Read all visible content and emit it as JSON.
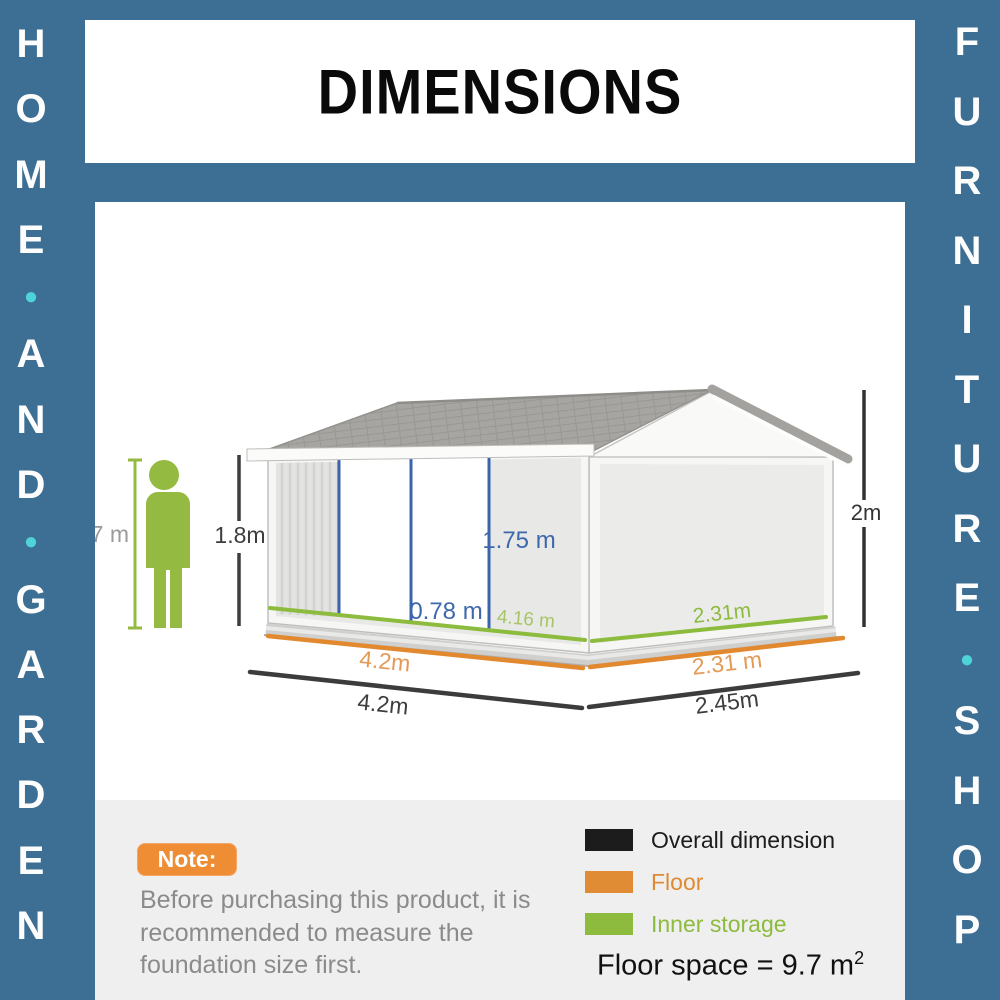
{
  "brand": {
    "left_letters": [
      "H",
      "O",
      "M",
      "E",
      "●",
      "A",
      "N",
      "D",
      "●",
      "G",
      "A",
      "R",
      "D",
      "E",
      "N"
    ],
    "right_letters": [
      "F",
      "U",
      "R",
      "N",
      "I",
      "T",
      "U",
      "R",
      "E",
      "●",
      "S",
      "H",
      "O",
      "P"
    ]
  },
  "header": {
    "title": "DIMENSIONS"
  },
  "diagram": {
    "person_height": "1.7 m",
    "wall_height": "1.8m",
    "door_height": "1.75 m",
    "door_width": "0.78 m",
    "inner_length": "4.16 m",
    "inner_width": "2.31m",
    "floor_length": "4.2m",
    "floor_width": "2.31 m",
    "overall_length": "4.2m",
    "overall_width": "2.45m",
    "overall_height": "2m"
  },
  "note": {
    "label": "Note:",
    "text": "Before purchasing this product, it is recommended to measure the foundation size first."
  },
  "legend": {
    "items": [
      {
        "label": "Overall dimension",
        "color": "#1c1c1c",
        "text_color": "#1c1c1c"
      },
      {
        "label": "Floor",
        "color": "#df8c35",
        "text_color": "#df8a33"
      },
      {
        "label": "Inner storage",
        "color": "#8cbb3e",
        "text_color": "#8cbb3e"
      }
    ],
    "floor_space_prefix": "Floor space = 9.7 m",
    "floor_space_sup": "2"
  },
  "colors": {
    "frame_blue": "#3d6e94",
    "accent_turquoise": "#4ed3d8",
    "panel_gray": "#f0efef",
    "note_orange": "#ef8d35",
    "dim_black": "#3b3b3b",
    "floor_orange": "#e2892f",
    "storage_green": "#8cbb3e",
    "door_blue": "#3a63ab",
    "figure_green": "#95ba41"
  }
}
